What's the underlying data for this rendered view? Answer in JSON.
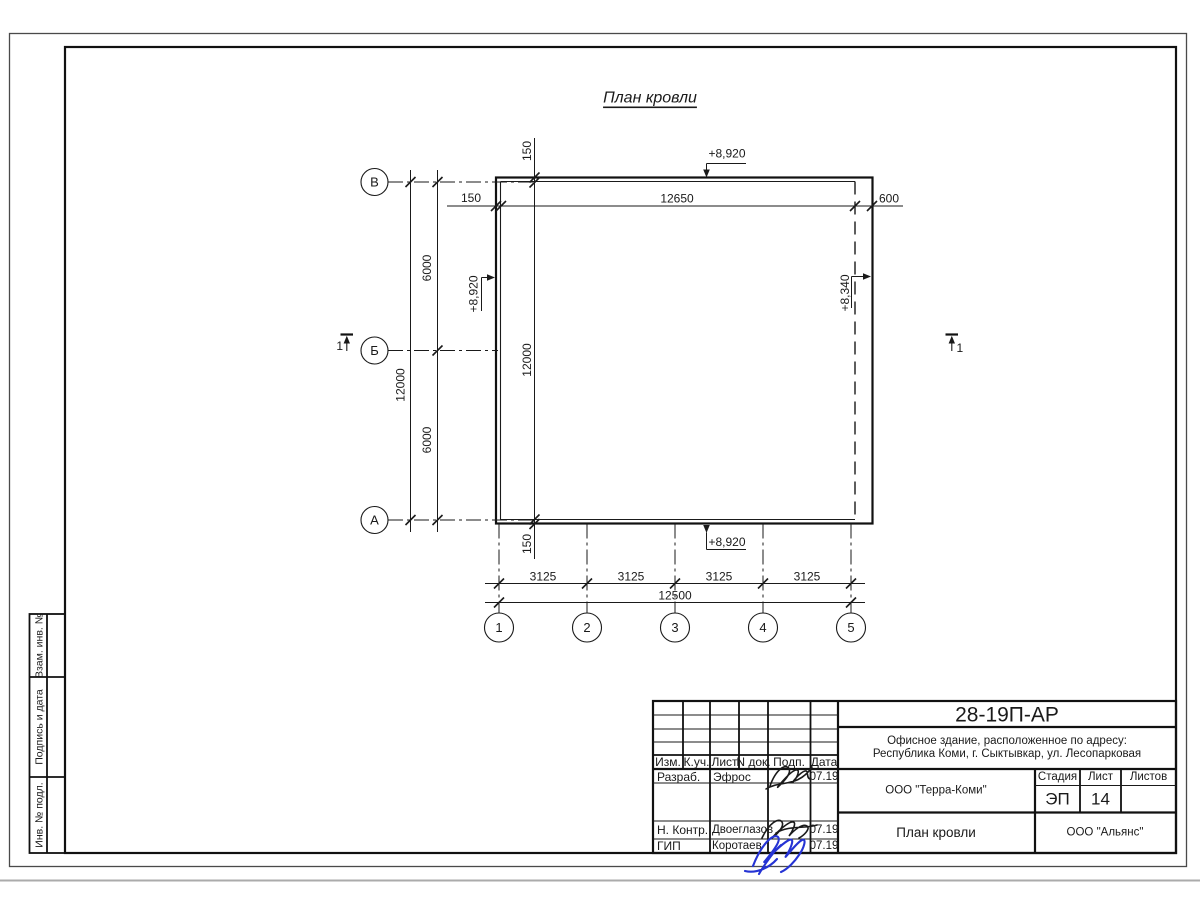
{
  "drawing": {
    "title": "План кровли",
    "axes": {
      "left": [
        "В",
        "Б",
        "А"
      ],
      "bottom": [
        "1",
        "2",
        "3",
        "4",
        "5"
      ]
    },
    "dims": {
      "overhang_left": "150",
      "top_total": "12650",
      "overhang_right": "600",
      "left_total": "12000",
      "left_span_top": "6000",
      "left_span_bottom": "6000",
      "overhang_top": "150",
      "inner_height": "12000",
      "overhang_bottom": "150",
      "bays": [
        "3125",
        "3125",
        "3125",
        "3125"
      ],
      "bottom_total": "12500"
    },
    "elevations": {
      "top": "+8,920",
      "left": "+8,920",
      "bottom": "+8,920",
      "right": "+8,340"
    },
    "section_mark": "1"
  },
  "titleblock": {
    "doc_number": "28-19П-АР",
    "object_line1": "Офисное здание, расположенное по адресу:",
    "object_line2": "Республика Коми, г. Сыктывкар, ул. Лесопарковая",
    "company": "ООО \"Терра-Коми\"",
    "sheet_title": "План кровли",
    "contractor": "ООО \"Альянс\"",
    "stage_label": "Стадия",
    "sheet_label": "Лист",
    "sheets_label": "Листов",
    "stage_value": "ЭП",
    "sheet_value": "14",
    "header": {
      "izm": "Изм.",
      "kuch": "К.уч.",
      "list": "Лист",
      "ndok": "N док.",
      "podp": "Подп.",
      "data": "Дата"
    },
    "rows": [
      {
        "role": "Разраб.",
        "name": "Эфрос",
        "date": "07.19"
      },
      {
        "role": "Н. Контр.",
        "name": "Двоеглазов",
        "date": "07.19"
      },
      {
        "role": "ГИП",
        "name": "Коротаев",
        "date": "07.19"
      }
    ]
  },
  "side_strip": {
    "cells": [
      "Взам. инв. №",
      "Подпись и дата",
      "Инв. № подл."
    ]
  },
  "colors": {
    "ink": "#1a1a1a",
    "signature_blue": "#2533d4"
  }
}
